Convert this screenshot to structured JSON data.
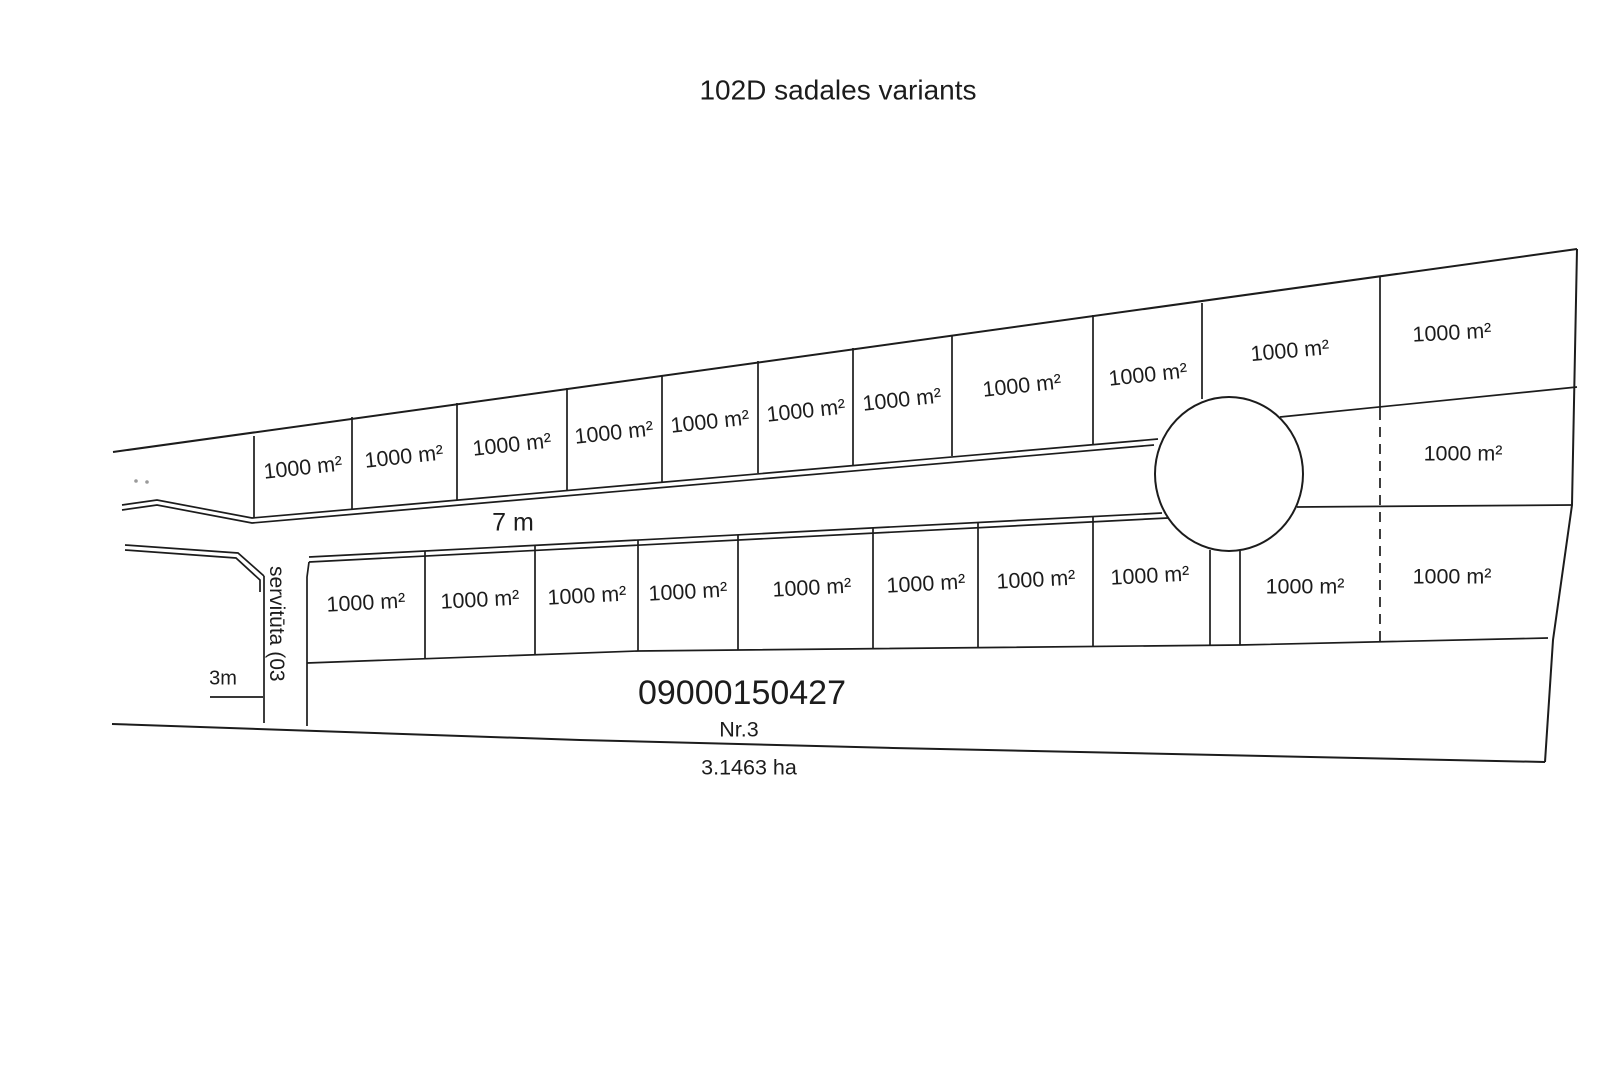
{
  "title": "102D sadales variants",
  "plots": {
    "area_label": "1000 m²",
    "count": 22
  },
  "road": {
    "width_label": "7 m"
  },
  "servitude_strip": {
    "label": "servitūta (03",
    "width_label": "3m"
  },
  "main_parcel": {
    "cadastral_number": "09000150427",
    "plot_number": "Nr.3",
    "total_area": "3.1463 ha"
  },
  "colors": {
    "line": "#1c1c1c",
    "background": "#ffffff"
  }
}
